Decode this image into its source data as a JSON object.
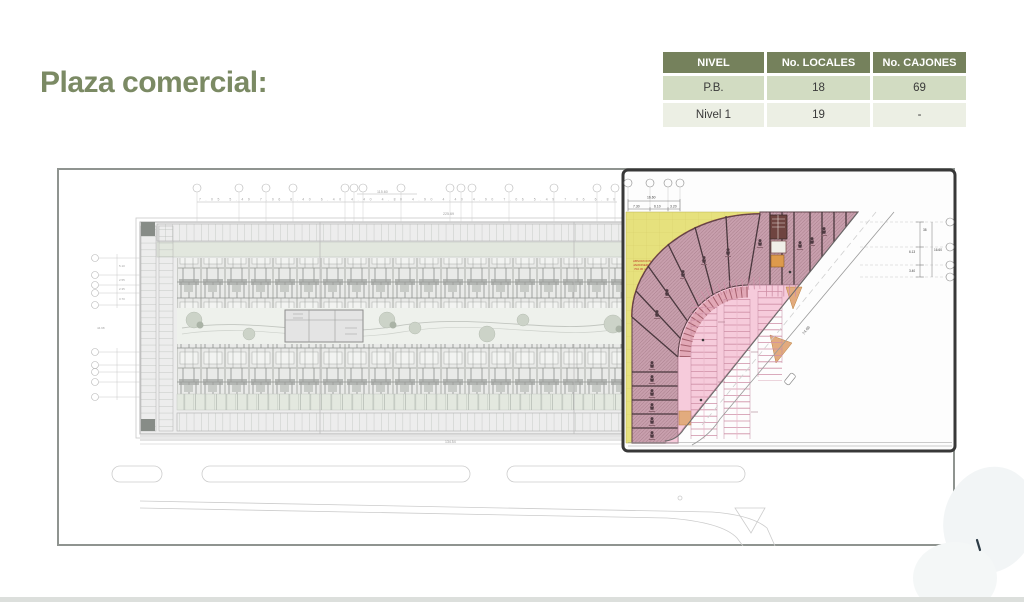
{
  "title": "Plaza comercial:",
  "table": {
    "headers": [
      "NIVEL",
      "No. LOCALES",
      "No. CAJONES"
    ],
    "rows": [
      [
        "P.B.",
        "18",
        "69"
      ],
      [
        "Nivel 1",
        "19",
        "-"
      ]
    ]
  },
  "colors": {
    "title_green": "#7b8a64",
    "header_green": "#75815c",
    "row_green": "#d2dcc2",
    "row_light": "#ecefe4",
    "plaza_yellow": "#e6e17d",
    "plaza_band_mauve": "#c89fad",
    "plaza_pink": "#f6cbdb",
    "plaza_tan": "#e2ab7e",
    "outline_dark": "#4a383e"
  },
  "siteplan": {
    "top_dims": "7.05  5.49  7.06 6.40  6.40  4.40  4.80  4.90  4.40  4.90  7.06  5.49  7.06  6.80",
    "top_total": "115.60",
    "top_total_2": "225.69",
    "bottom_total": "134.54",
    "left_dims": [
      "5.10",
      "2.55",
      "2.35",
      "3.70"
    ],
    "left_total": "44.98"
  },
  "plaza": {
    "dim_total_top": "16.60",
    "dim_top_segments": [
      "7.30",
      "6.10",
      "3.20"
    ],
    "dim_total_right": "16.60",
    "dim_right_segments": [
      "38",
      "6.13",
      "3.40"
    ],
    "dim_diagonal": "74.66",
    "green_area_label": [
      "ABSORCION",
      "JARDINERA",
      "702.30 m2"
    ]
  }
}
